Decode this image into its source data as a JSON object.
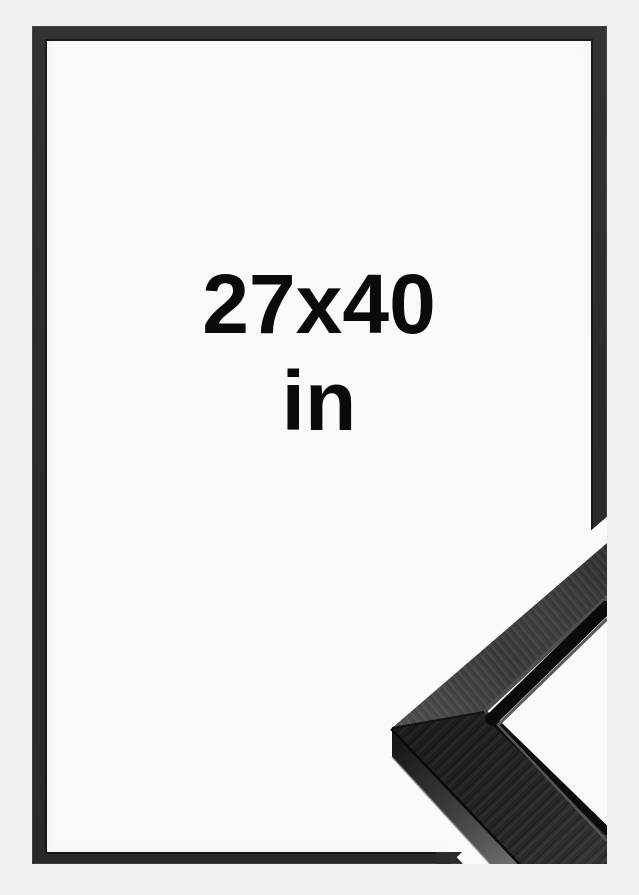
{
  "product": {
    "size_label": "27x40",
    "unit_label": "in",
    "description": "black picture frame mockup with corner profile detail"
  },
  "colors": {
    "bg": "#f0f0ef",
    "mat": "#fafafa",
    "frame": "#2c2c2c",
    "ink": "#0a0a0a",
    "face-upper": "#3f3f3f",
    "face-lower": "#2b2b2b",
    "groove": "#0b0b0b",
    "sliver": "#5a5a5a"
  }
}
